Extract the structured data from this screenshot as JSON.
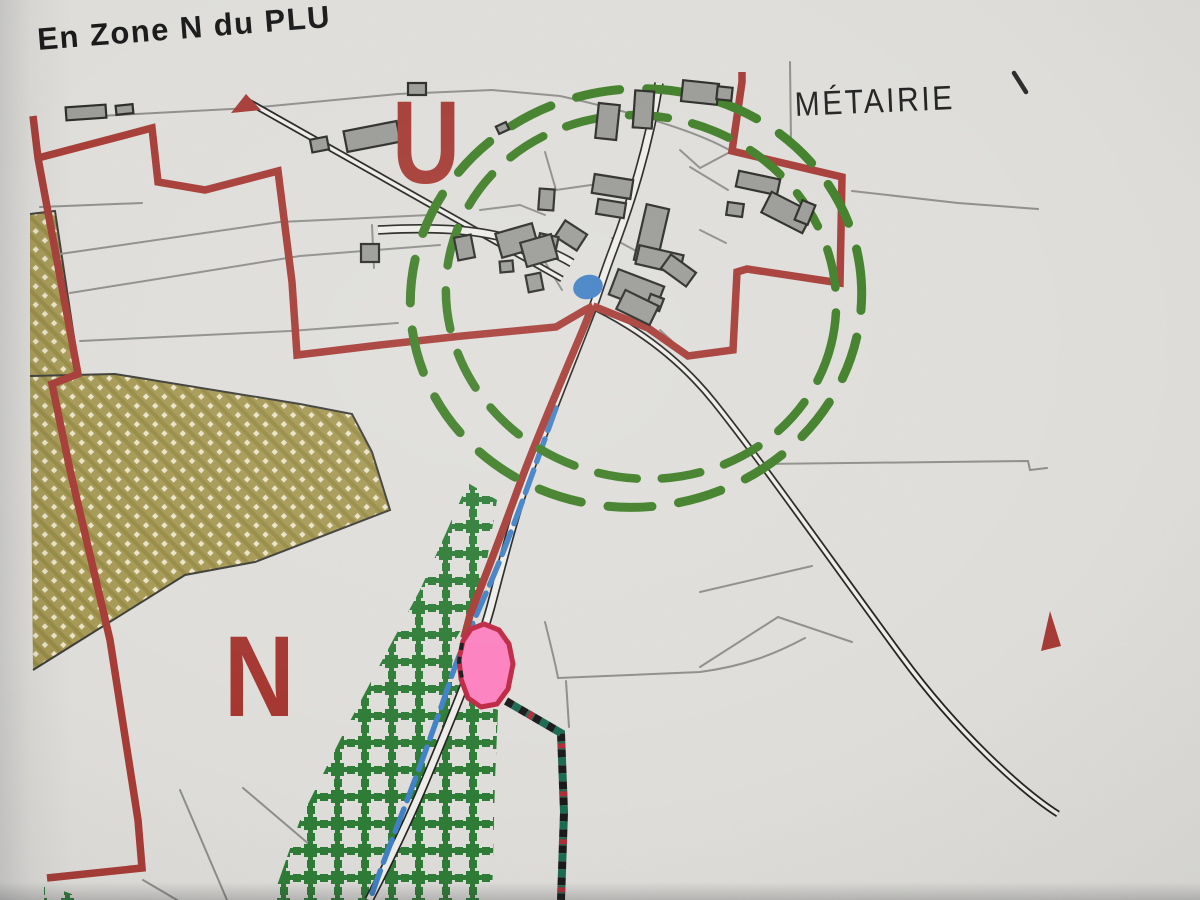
{
  "photo": {
    "title": "En Zone N du PLU",
    "labels": {
      "metairie": "MÉTAIRIE",
      "zone_u": "U",
      "zone_n": "N"
    }
  },
  "colors": {
    "paper": "#e0dfdb",
    "red_boundary": "#a63832",
    "green_dash": "#3c7d23",
    "trellis_green": "#2a7b33",
    "khaki": "#a69953",
    "khaki_dark_stripe": "#968a42",
    "khaki_dot": "#ece5c8",
    "khaki_outline": "#3a3a35",
    "building_fill": "#9a9a96",
    "building_stroke": "#262622",
    "parcel_line": "#8d8d89",
    "road_casing": "#1f1f1d",
    "road_fill": "#f0efeb",
    "stream_blue": "#3d80c6",
    "pond_blue": "#3e7fc5",
    "pink_fill": "#ff80c0",
    "pink_stroke": "#bf2440",
    "dotted_teal": "#17684f",
    "dotted_black": "#161616",
    "dotted_red": "#b02936",
    "tick_dark": "#2a2a2a"
  },
  "map": {
    "khaki_zones": [
      "30,214 55,210 80,377 30,379",
      "30,378 115,374 300,404 352,414 372,452 390,510 255,562 185,575 33,670"
    ],
    "khaki_outlines": [
      "M 30,376 L 115,374 L 300,404 L 352,414 L 372,452 L 390,510 L 255,562 L 185,575 L 33,670",
      "M 30,214 L 55,211 L 80,377"
    ],
    "trellis_zones": [
      "468,483 497,500 487,560 470,615 455,640 452,665 462,695 498,710 495,780 492,900 272,900 300,820 340,740 385,655 420,590 445,535",
      "44,884 88,900 44,900"
    ],
    "parcel_lines": [
      "M 80,117 L 250,108 L 398,94 L 492,90 L 560,96",
      "M 560,96 C 640,114 700,133 731,151",
      "M 40,207 L 142,203",
      "M 60,254 L 280,222 L 430,215",
      "M 70,293 L 300,256 L 440,245",
      "M 80,341 L 290,331 L 398,323",
      "M 852,191 L 958,203 L 1038,209",
      "M 790,62 L 791,143",
      "M 762,464 L 1028,461 L 1030,470 L 1047,468",
      "M 545,622 C 552,650 556,666 558,678",
      "M 558,678 L 700,672 C 745,666 775,654 805,638",
      "M 566,681 L 569,727",
      "M 180,790 L 227,900",
      "M 243,788 L 310,845",
      "M 143,880 L 177,900",
      "M 700,592 L 812,566",
      "M 700,667 L 778,617",
      "M 778,617 L 852,642",
      "M 545,152 L 556,190 L 598,184",
      "M 520,205 L 545,215",
      "M 480,210 L 520,205",
      "M 680,150 L 700,168 L 730,152",
      "M 700,230 L 726,243",
      "M 612,238 L 638,252",
      "M 545,262 L 562,290",
      "M 660,330 L 688,356",
      "M 690,167 L 728,190",
      "M 372,225 L 374,268"
    ],
    "railway": "M 247,101 L 562,279",
    "road_se": "M 596,308 C 642,331 682,362 714,402 C 762,462 832,562 902,657 C 958,733 1022,791 1058,814",
    "road_main": "M 659,83 C 648,150 630,205 613,250 C 603,276 599,291 593,307 C 574,356 551,413 534,459 C 517,505 504,556 491,606 C 477,657 454,712 429,772 C 407,825 384,871 369,900",
    "road_west": "M 378,230 C 432,227 472,229 506,238 C 534,245 556,253 572,263",
    "stream": "M 556,408 C 540,452 520,510 498,565 C 482,604 465,638 452,675 C 438,718 416,778 395,832 C 387,853 378,876 371,897",
    "red_paths": [
      "M 33,116 L 38,158 L 78,374 L 52,384 L 70,470 L 110,640 L 138,820 L 142,868 L 47,878",
      "M 38,158 L 152,128 L 158,182 L 205,190 L 278,171 L 292,282 L 297,355 L 380,345 L 462,336 L 556,327 L 585,310 L 593,306",
      "M 593,306 L 648,328 L 688,356 L 733,350 L 737,272 L 747,269 L 840,283 L 842,177 L 732,151 L 742,82 L 742,72",
      "M 593,306 C 570,360 540,430 522,478 C 507,519 488,570 470,615 L 464,638"
    ],
    "red_polygons": [
      "231,113 246,94 261,110",
      "1041,651 1050,611 1061,646"
    ],
    "green_circles": [
      {
        "cx": 636,
        "cy": 298,
        "rx": 226,
        "ry": 209,
        "dash": "44 27",
        "w": 9,
        "rot": -8
      },
      {
        "cx": 641,
        "cy": 297,
        "rx": 196,
        "ry": 181,
        "dash": "39 25",
        "w": 8.5,
        "rot": 14
      }
    ],
    "pond": {
      "cx": 588,
      "cy": 287,
      "rx": 15,
      "ry": 12,
      "rot": -15
    },
    "pink_parcel": {
      "points": "463,641 471,629 484,624 499,630 509,644 513,664 508,689 497,704 481,707 468,698 461,679 459,659",
      "black_dash_edge": "M 462,643 L 459,662 L 463,684"
    },
    "dotted_boundary": "M 506,701 L 561,733 L 564,812 L 561,900",
    "metairie_tick": "M 1014,73 L 1026,92",
    "buildings": [
      [
        66,
        106,
        40,
        13,
        -4
      ],
      [
        116,
        105,
        17,
        9,
        -6
      ],
      [
        345,
        126,
        54,
        21,
        -11
      ],
      [
        311,
        138,
        17,
        13,
        -11
      ],
      [
        408,
        83,
        18,
        12,
        0
      ],
      [
        597,
        104,
        21,
        35,
        6
      ],
      [
        634,
        91,
        19,
        37,
        4
      ],
      [
        682,
        82,
        36,
        21,
        6
      ],
      [
        717,
        87,
        15,
        13,
        6
      ],
      [
        737,
        175,
        42,
        16,
        12
      ],
      [
        764,
        201,
        46,
        23,
        27
      ],
      [
        727,
        203,
        16,
        13,
        8
      ],
      [
        798,
        202,
        14,
        21,
        22
      ],
      [
        593,
        177,
        39,
        19,
        9
      ],
      [
        597,
        201,
        28,
        15,
        9
      ],
      [
        539,
        189,
        15,
        21,
        4
      ],
      [
        558,
        226,
        26,
        19,
        33
      ],
      [
        538,
        235,
        19,
        17,
        12
      ],
      [
        640,
        206,
        23,
        57,
        13
      ],
      [
        637,
        250,
        45,
        19,
        13
      ],
      [
        663,
        262,
        31,
        17,
        36
      ],
      [
        612,
        277,
        49,
        27,
        21
      ],
      [
        648,
        296,
        14,
        13,
        21
      ],
      [
        619,
        297,
        37,
        21,
        26
      ],
      [
        498,
        228,
        38,
        25,
        -16
      ],
      [
        523,
        238,
        32,
        25,
        -16
      ],
      [
        456,
        236,
        17,
        23,
        -11
      ],
      [
        500,
        261,
        13,
        11,
        -5
      ],
      [
        527,
        274,
        15,
        17,
        -11
      ],
      [
        361,
        244,
        18,
        18,
        0
      ],
      [
        497,
        124,
        11,
        8,
        -25
      ]
    ]
  }
}
